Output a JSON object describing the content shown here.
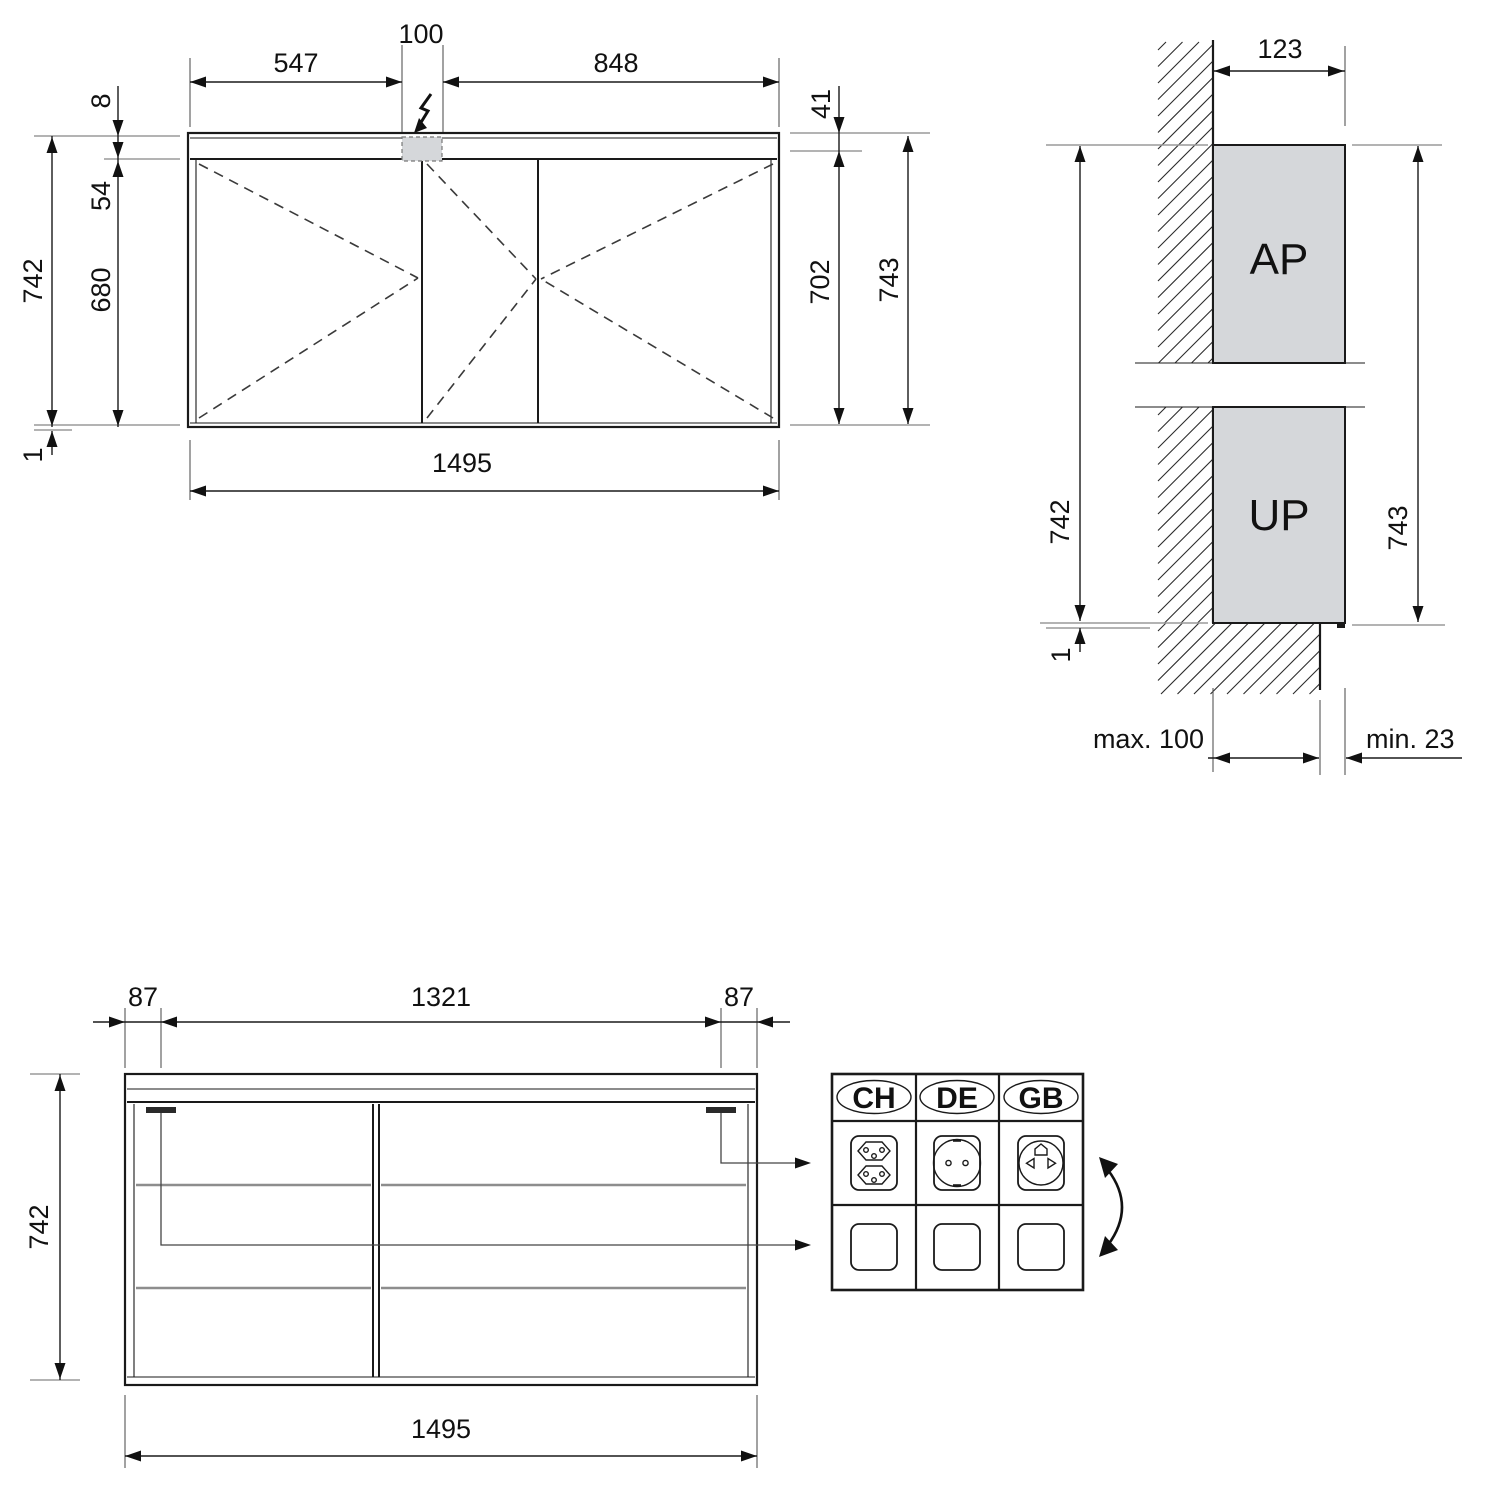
{
  "front_view": {
    "dim_left_door": "547",
    "dim_connection_zone": "100",
    "dim_right_door": "848",
    "dim_top_gap": "8",
    "dim_light_strip": "54",
    "dim_door_height": "680",
    "dim_body_height": "742",
    "dim_bottom_gap": "1",
    "dim_top_profile": "41",
    "dim_mirror_height": "702",
    "dim_total_height": "743",
    "dim_total_width": "1495"
  },
  "side_view": {
    "dim_depth": "123",
    "dim_body_height": "742",
    "dim_total_height": "743",
    "dim_bottom_gap": "1",
    "label_surface_mounted": "AP",
    "label_flush_mounted": "UP",
    "dim_max_recess": "max. 100",
    "dim_min_protrusion": "min. 23"
  },
  "plan_view": {
    "dim_socket_offset_left": "87",
    "dim_socket_spacing": "1321",
    "dim_socket_offset_right": "87",
    "dim_depth_total": "742",
    "dim_total_width": "1495"
  },
  "socket_table": {
    "countries": [
      {
        "code": "CH"
      },
      {
        "code": "DE"
      },
      {
        "code": "GB"
      }
    ]
  },
  "colors": {
    "line": "#1a1a1a",
    "panel_gray": "#d5d7da",
    "extension_gray": "#9a9a9a"
  }
}
